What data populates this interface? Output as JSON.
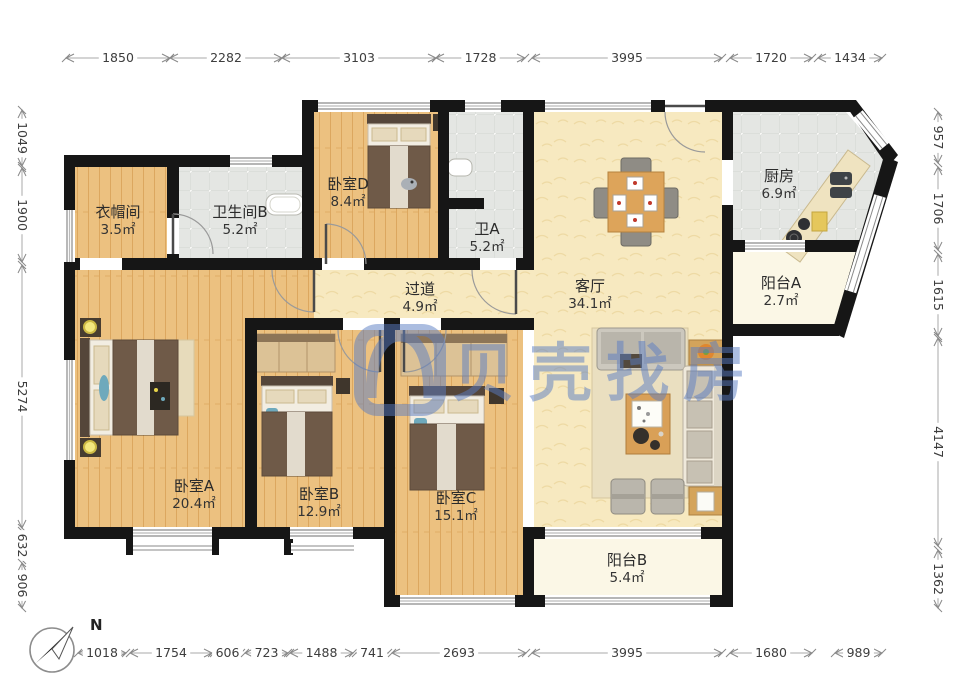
{
  "watermark": {
    "text": "贝壳找房",
    "color": "#5a7dc3",
    "opacity": 0.5
  },
  "compass": {
    "label": "N"
  },
  "colors": {
    "wall": "#161616",
    "wood": "#ecc180",
    "tile": "#e4e6e3",
    "cream": "#f7e9c0",
    "balcony": "#fbf7e6"
  },
  "rooms": [
    {
      "id": "cloakroom",
      "name": "衣帽间",
      "area": "3.5㎡",
      "x": 118,
      "y": 212
    },
    {
      "id": "bathroom-b",
      "name": "卫生间B",
      "area": "5.2㎡",
      "x": 240,
      "y": 212
    },
    {
      "id": "bedroom-d",
      "name": "卧室D",
      "area": "8.4㎡",
      "x": 348,
      "y": 184
    },
    {
      "id": "bathroom-a",
      "name": "卫A",
      "area": "5.2㎡",
      "x": 487,
      "y": 229
    },
    {
      "id": "kitchen",
      "name": "厨房",
      "area": "6.9㎡",
      "x": 779,
      "y": 176
    },
    {
      "id": "balcony-a",
      "name": "阳台A",
      "area": "2.7㎡",
      "x": 781,
      "y": 283
    },
    {
      "id": "hallway",
      "name": "过道",
      "area": "4.9㎡",
      "x": 420,
      "y": 289
    },
    {
      "id": "living-room",
      "name": "客厅",
      "area": "34.1㎡",
      "x": 590,
      "y": 286
    },
    {
      "id": "bedroom-a",
      "name": "卧室A",
      "area": "20.4㎡",
      "x": 194,
      "y": 486
    },
    {
      "id": "bedroom-b",
      "name": "卧室B",
      "area": "12.9㎡",
      "x": 319,
      "y": 494
    },
    {
      "id": "bedroom-c",
      "name": "卧室C",
      "area": "15.1㎡",
      "x": 456,
      "y": 498
    },
    {
      "id": "balcony-b",
      "name": "阳台B",
      "area": "5.4㎡",
      "x": 627,
      "y": 560
    }
  ],
  "dimensions": {
    "top": {
      "axis": 58,
      "segments": [
        {
          "value": "1850",
          "from": 66,
          "to": 170
        },
        {
          "value": "2282",
          "from": 170,
          "to": 282
        },
        {
          "value": "3103",
          "from": 282,
          "to": 436
        },
        {
          "value": "1728",
          "from": 436,
          "to": 525
        },
        {
          "value": "3995",
          "from": 532,
          "to": 722
        },
        {
          "value": "1720",
          "from": 730,
          "to": 812
        },
        {
          "value": "1434",
          "from": 818,
          "to": 882
        }
      ]
    },
    "bottom": {
      "axis": 653,
      "segments": [
        {
          "value": "1018",
          "from": 78,
          "to": 126
        },
        {
          "value": "1754",
          "from": 130,
          "to": 212
        },
        {
          "value": "606",
          "from": 214,
          "to": 241
        },
        {
          "value": "723",
          "from": 245,
          "to": 288
        },
        {
          "value": "1488",
          "from": 290,
          "to": 353
        },
        {
          "value": "741",
          "from": 356,
          "to": 388
        },
        {
          "value": "2693",
          "from": 392,
          "to": 526
        },
        {
          "value": "3995",
          "from": 532,
          "to": 722
        },
        {
          "value": "1680",
          "from": 730,
          "to": 812
        },
        {
          "value": "989",
          "from": 835,
          "to": 882
        }
      ]
    },
    "left": {
      "axis": 22,
      "segments": [
        {
          "value": "1049",
          "from": 110,
          "to": 166
        },
        {
          "value": "1900",
          "from": 168,
          "to": 262
        },
        {
          "value": "5274",
          "from": 265,
          "to": 528
        },
        {
          "value": "632",
          "from": 531,
          "to": 560
        },
        {
          "value": "906",
          "from": 563,
          "to": 608
        }
      ]
    },
    "right": {
      "axis": 938,
      "segments": [
        {
          "value": "957",
          "from": 112,
          "to": 163
        },
        {
          "value": "1706",
          "from": 167,
          "to": 250
        },
        {
          "value": "1615",
          "from": 254,
          "to": 336
        },
        {
          "value": "4147",
          "from": 338,
          "to": 546
        },
        {
          "value": "1362",
          "from": 550,
          "to": 608
        }
      ]
    }
  }
}
